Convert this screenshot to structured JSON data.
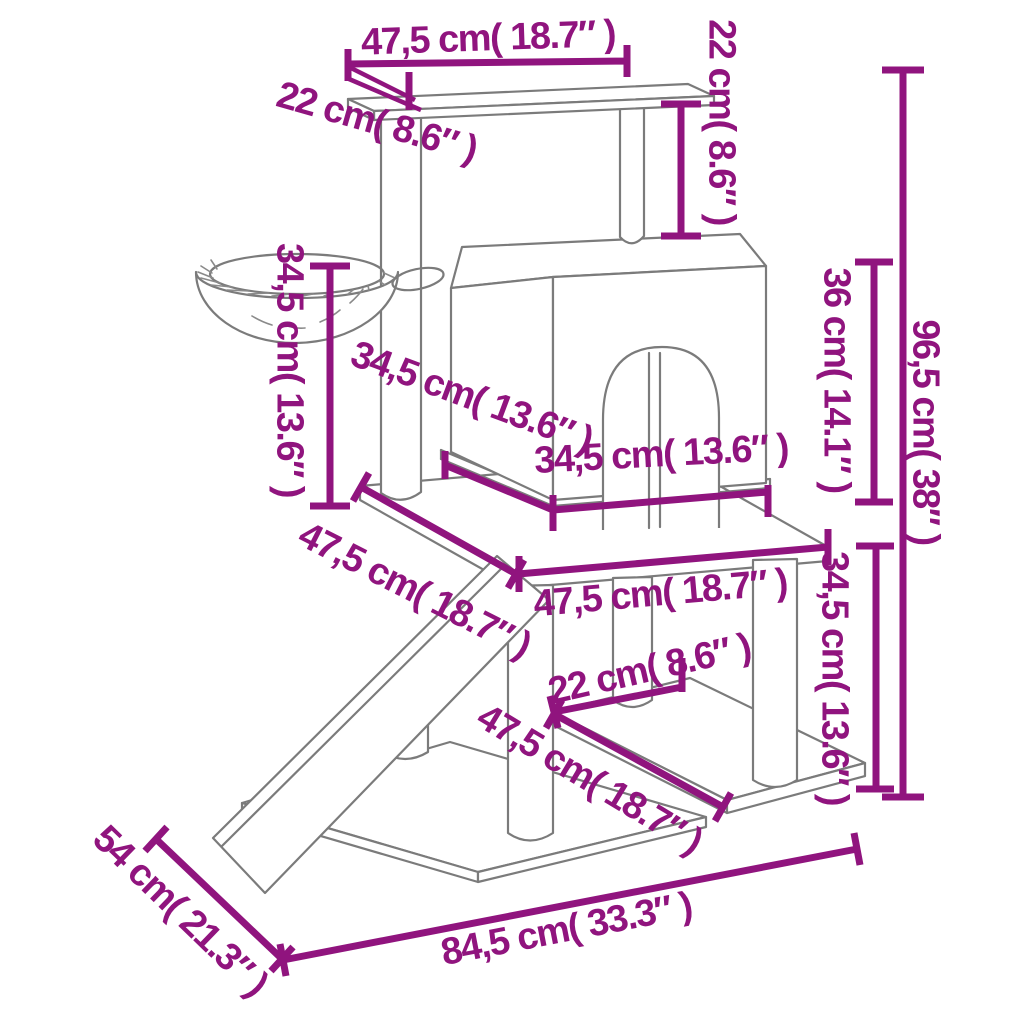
{
  "diagram": {
    "subject": "cat-tree-with-scratching-posts-dimension-diagram",
    "background_color": "#ffffff",
    "outline_color": "#7b7b7b",
    "dimension_color": "#90147E",
    "unit_primary": "cm",
    "unit_secondary": "inch"
  },
  "dimensions": {
    "top_platform_width": {
      "label": "47,5 cm( 18.7″ )",
      "cm": 47.5,
      "inch": 18.7
    },
    "top_platform_depth": {
      "label": "22 cm( 8.6″ )",
      "cm": 22,
      "inch": 8.6
    },
    "top_clearance_height": {
      "label": "22 cm( 8.6″ )",
      "cm": 22,
      "inch": 8.6
    },
    "basket_post_height": {
      "label": "34,5 cm( 13.6″ )",
      "cm": 34.5,
      "inch": 13.6
    },
    "house_depth": {
      "label": "34,5 cm( 13.6″ )",
      "cm": 34.5,
      "inch": 13.6
    },
    "house_width": {
      "label": "34,5 cm( 13.6″ )",
      "cm": 34.5,
      "inch": 13.6
    },
    "house_height": {
      "label": "36 cm( 14.1″ )",
      "cm": 36,
      "inch": 14.1
    },
    "overall_height": {
      "label": "96,5 cm( 38″ )",
      "cm": 96.5,
      "inch": 38
    },
    "middle_platform_depth": {
      "label": "47,5 cm( 18.7″ )",
      "cm": 47.5,
      "inch": 18.7
    },
    "middle_platform_width": {
      "label": "47,5 cm( 18.7″ )",
      "cm": 47.5,
      "inch": 18.7
    },
    "post_spacing": {
      "label": "22 cm( 8.6″ )",
      "cm": 22,
      "inch": 8.6
    },
    "lower_platform_depth": {
      "label": "47,5 cm( 18.7″ )",
      "cm": 47.5,
      "inch": 18.7
    },
    "lower_section_height": {
      "label": "34,5 cm( 13.6″ )",
      "cm": 34.5,
      "inch": 13.6
    },
    "base_depth": {
      "label": "54 cm( 21.3″ )",
      "cm": 54,
      "inch": 21.3
    },
    "base_width": {
      "label": "84,5 cm( 33.3″ )",
      "cm": 84.5,
      "inch": 33.3
    }
  }
}
